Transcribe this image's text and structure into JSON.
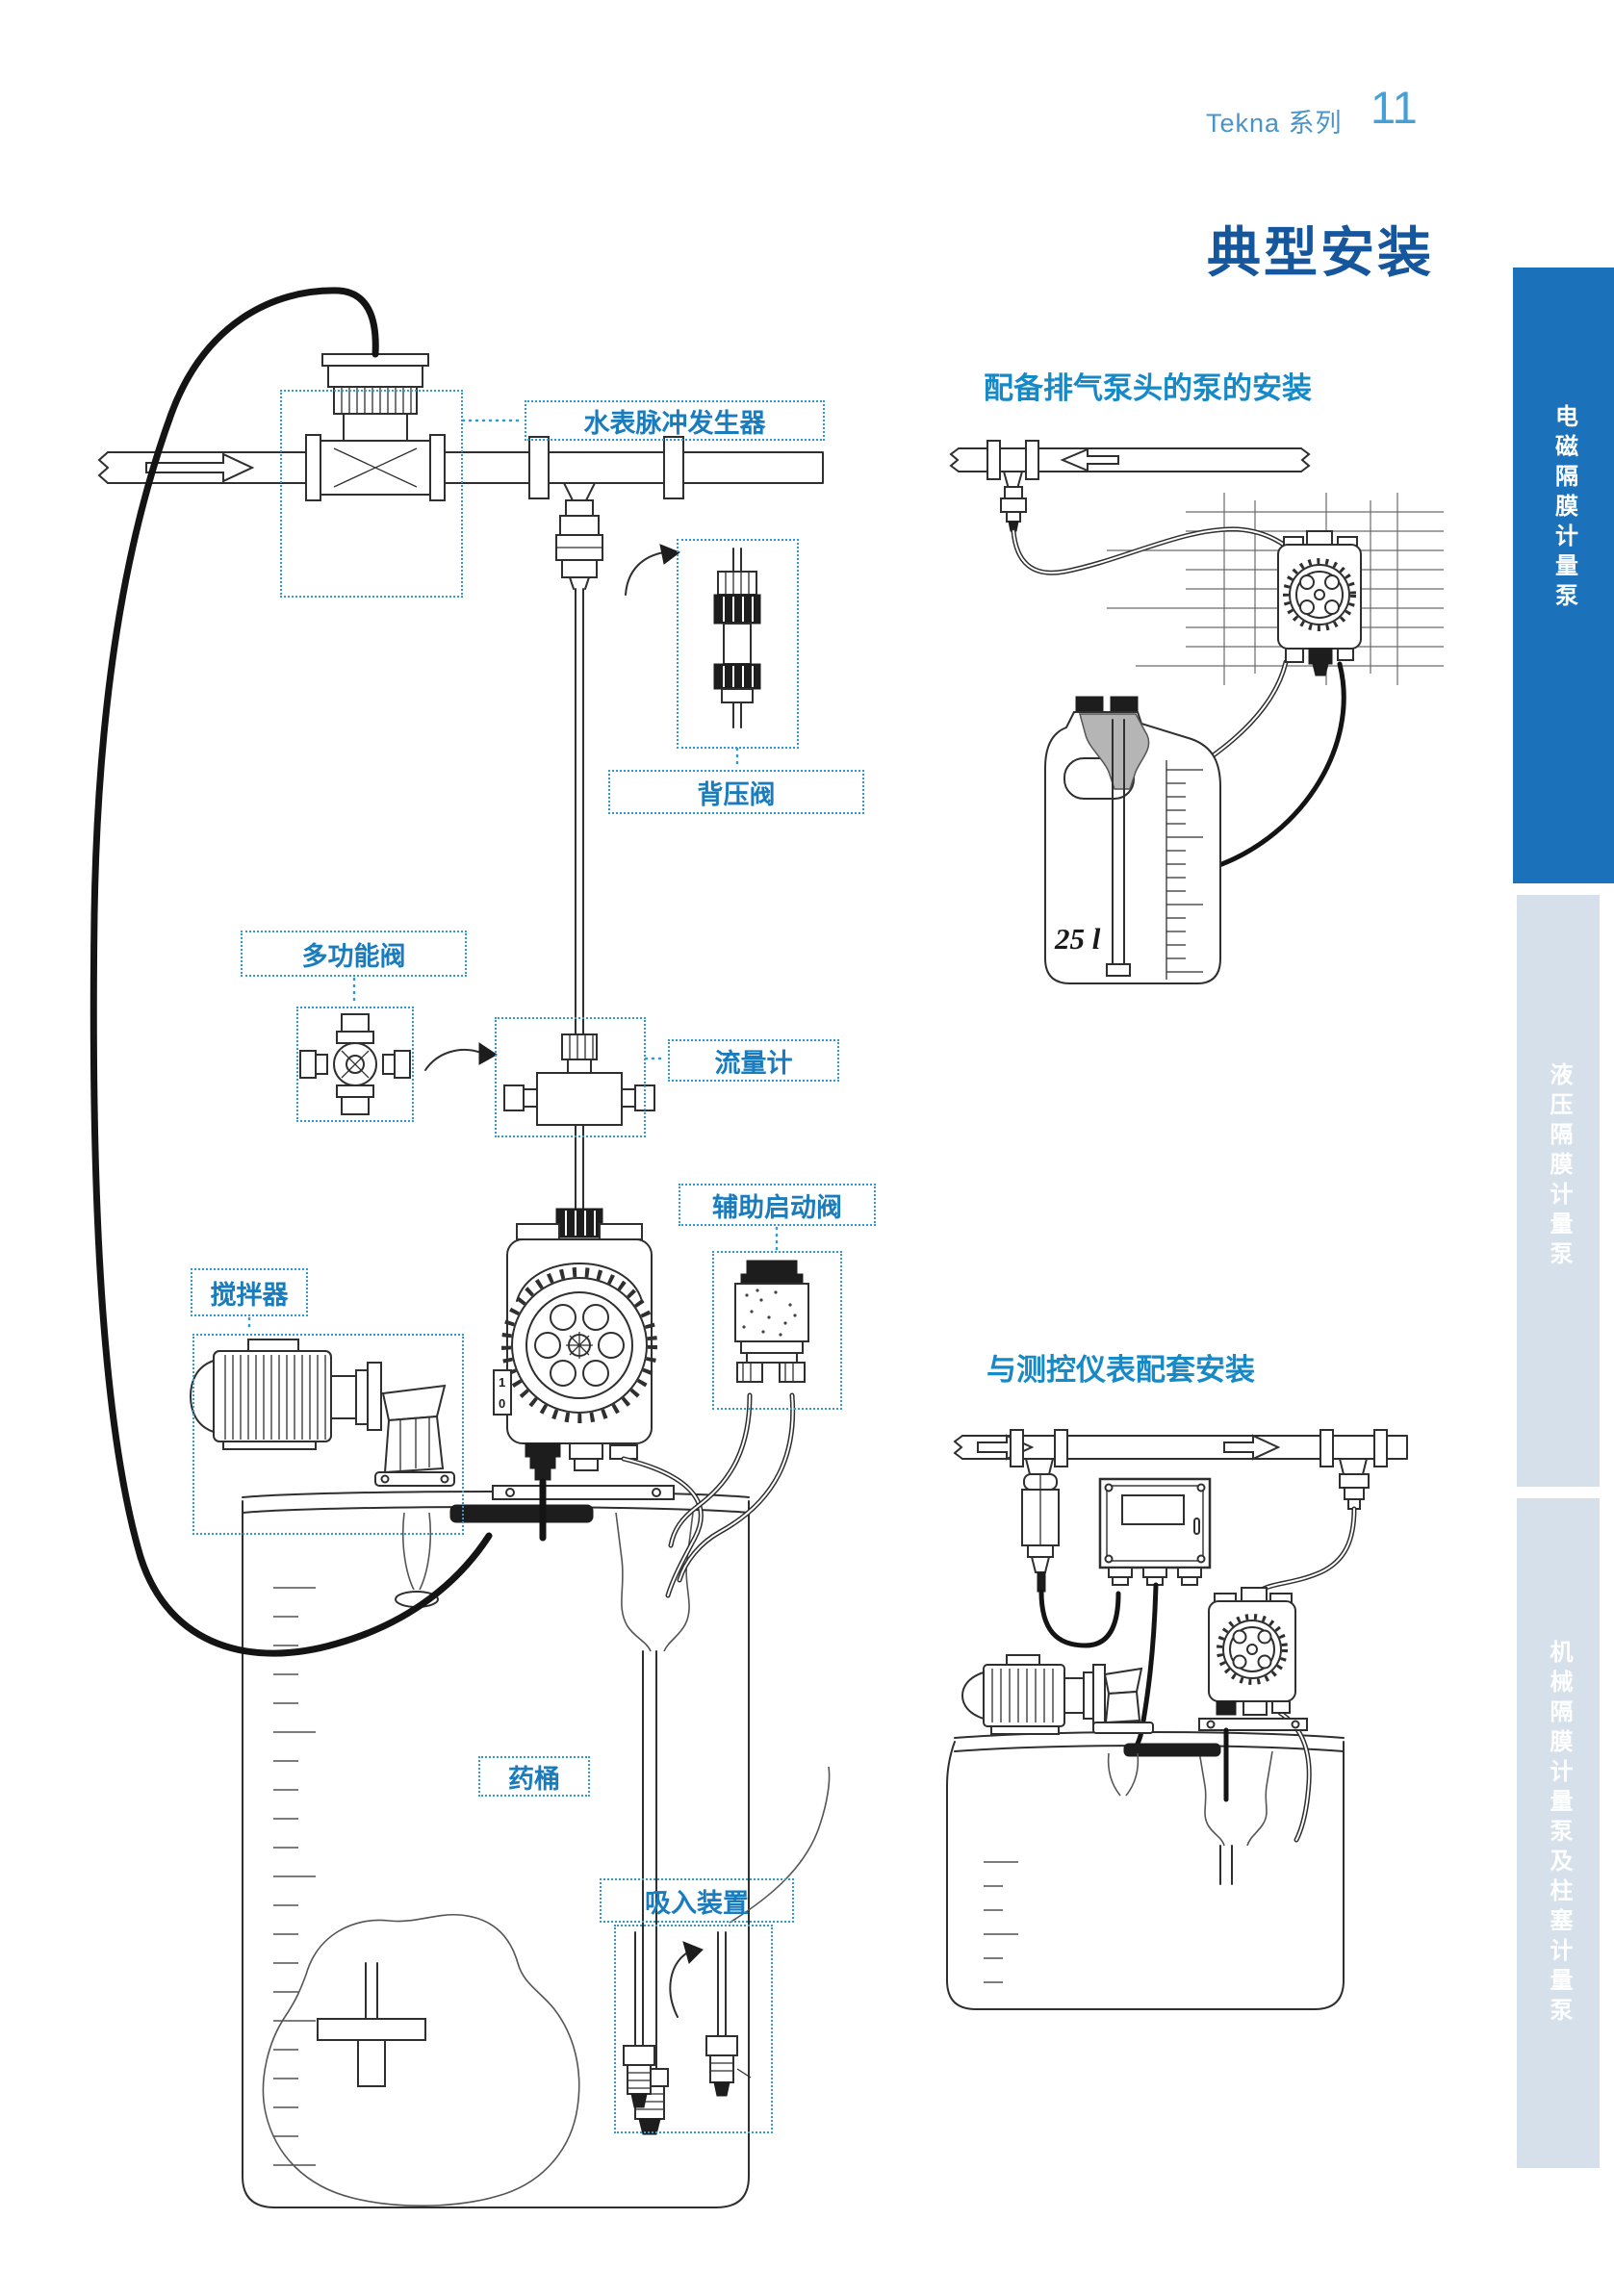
{
  "header": {
    "series_label": "Tekna 系列",
    "page_number": "11"
  },
  "title": "典型安装",
  "right_sections": {
    "top_heading": "配备排气泵头的泵的安装",
    "bottom_heading": "与测控仪表配套安装"
  },
  "component_labels": {
    "water_meter": "水表脉冲发生器",
    "back_pressure_valve": "背压阀",
    "multifunction_valve": "多功能阀",
    "flow_meter": "流量计",
    "aux_start_valve": "辅助启动阀",
    "agitator": "搅拌器",
    "chemical_tank": "药桶",
    "suction_device": "吸入装置"
  },
  "annotations": {
    "tank_volume": "25 l",
    "pump_switch_on": "1",
    "pump_switch_off": "0"
  },
  "sidebar": {
    "tabs": [
      {
        "label": "电磁隔膜计量泵",
        "active": true
      },
      {
        "label": "液压隔膜计量泵",
        "active": false
      },
      {
        "label": "机械隔膜计量泵及柱塞计量泵",
        "active": false
      }
    ]
  },
  "colors": {
    "title": "#15569d",
    "section_heading": "#1689c7",
    "label_text": "#1a7cbd",
    "callout_border": "#2e9ad0",
    "sidebar_active_bg": "#1b72ba",
    "sidebar_inactive_bg": "#d6e0ea",
    "sidebar_text": "#ffffff",
    "page_header_text": "#4a94c9",
    "page_number": "#44a0d6",
    "line_art": "#2f2f2f"
  }
}
